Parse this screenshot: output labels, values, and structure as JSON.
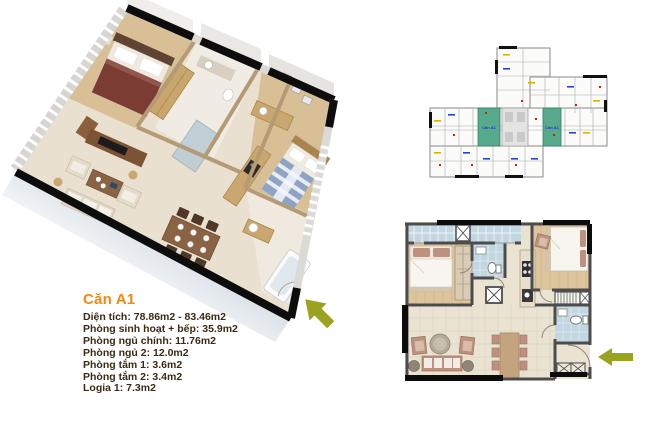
{
  "page": {
    "background": "#ffffff"
  },
  "info_panel": {
    "title": "Căn A1",
    "title_color": "#ee8912",
    "text_color": "#3b2a15",
    "lines": [
      "Diện tích: 78.86m2 - 83.46m2",
      "Phòng sinh hoạt + bếp: 35.9m2",
      "Phòng ngủ chính: 11.76m2",
      "Phòng ngủ 2: 12.0m2",
      "Phòng tắm 1: 3.6m2",
      "Phòng tắm 2: 3.4m2",
      "Logia 1: 7.3m2"
    ]
  },
  "building_overview": {
    "highlight_color": "#58aa8c",
    "label_color": "#2038c8",
    "highlighted_units": [
      {
        "label": "Căn A1"
      },
      {
        "label": "Căn A1"
      }
    ]
  },
  "arrows": {
    "color": "#9aa31f"
  }
}
